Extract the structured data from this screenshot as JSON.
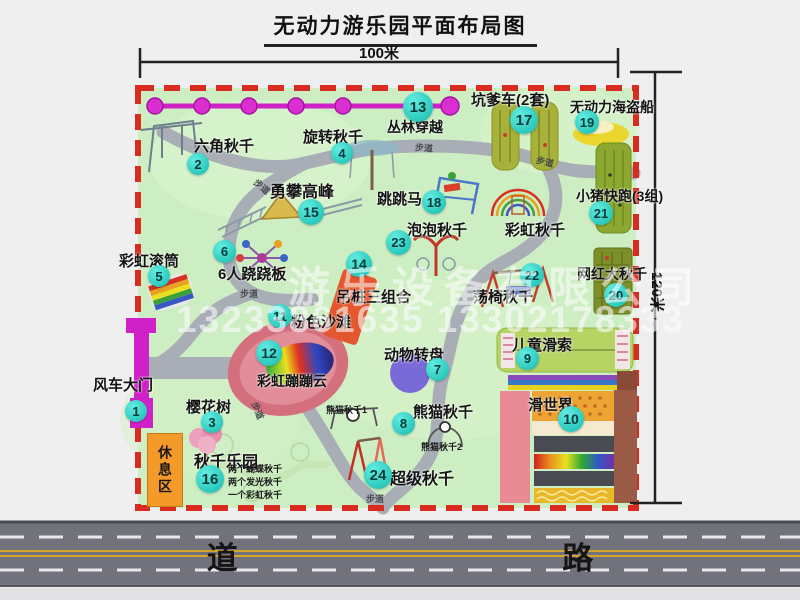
{
  "title": "无动力游乐园平面布局图",
  "dimensions": {
    "width_label": "100米",
    "height_label": "120米"
  },
  "watermark": {
    "company": "游乐设备有限公司",
    "phone": "13233861635 13302178333"
  },
  "road": {
    "label": "道    路"
  },
  "walkway_label": "步道",
  "rest_area_label": "休息区",
  "rainbow_swing_label": "彩虹秋千",
  "panda_swing_sub1": "熊猫秋千1",
  "panda_swing_sub2": "熊猫秋千2",
  "swing_park_notes": [
    "两个蝴蝶秋千",
    "两个发光秋千",
    "一个彩虹秋千"
  ],
  "items": [
    {
      "num": "1",
      "label": "风车大门"
    },
    {
      "num": "2",
      "label": "六角秋千"
    },
    {
      "num": "3",
      "label": "樱花树"
    },
    {
      "num": "4",
      "label": "旋转秋千"
    },
    {
      "num": "5",
      "label": "彩虹滚筒"
    },
    {
      "num": "6",
      "label": "6人跷跷板"
    },
    {
      "num": "7",
      "label": "动物转盘"
    },
    {
      "num": "8",
      "label": "熊猫秋千"
    },
    {
      "num": "9",
      "label": "儿童滑索"
    },
    {
      "num": "10",
      "label": "滑世界"
    },
    {
      "num": "11",
      "label": "粉色沙滩"
    },
    {
      "num": "12",
      "label": "彩虹蹦蹦云"
    },
    {
      "num": "13",
      "label": "丛林穿越"
    },
    {
      "num": "14",
      "label": "吊桩三组合"
    },
    {
      "num": "15",
      "label": "勇攀高峰"
    },
    {
      "num": "16",
      "label": "秋千乐园"
    },
    {
      "num": "17",
      "label": "坑爹车(2套)"
    },
    {
      "num": "18",
      "label": "跳跳马"
    },
    {
      "num": "19",
      "label": "无动力海盗船"
    },
    {
      "num": "20",
      "label": "网红大秋千"
    },
    {
      "num": "21",
      "label": "小猪快跑(3组)"
    },
    {
      "num": "22",
      "label": "荡椅秋千"
    },
    {
      "num": "23",
      "label": "泡泡秋千"
    },
    {
      "num": "24",
      "label": "超级秋千"
    }
  ],
  "colors": {
    "map_green": "#cdeec3",
    "border_red": "#d92b1f",
    "path_gray": "#a9aeb6",
    "road_gray": "#71727b",
    "badge_teal": "#2cc9bd",
    "zipline_magenta": "#cf22c6",
    "gate_magenta": "#d020c8",
    "rest_orange": "#f39a28"
  }
}
